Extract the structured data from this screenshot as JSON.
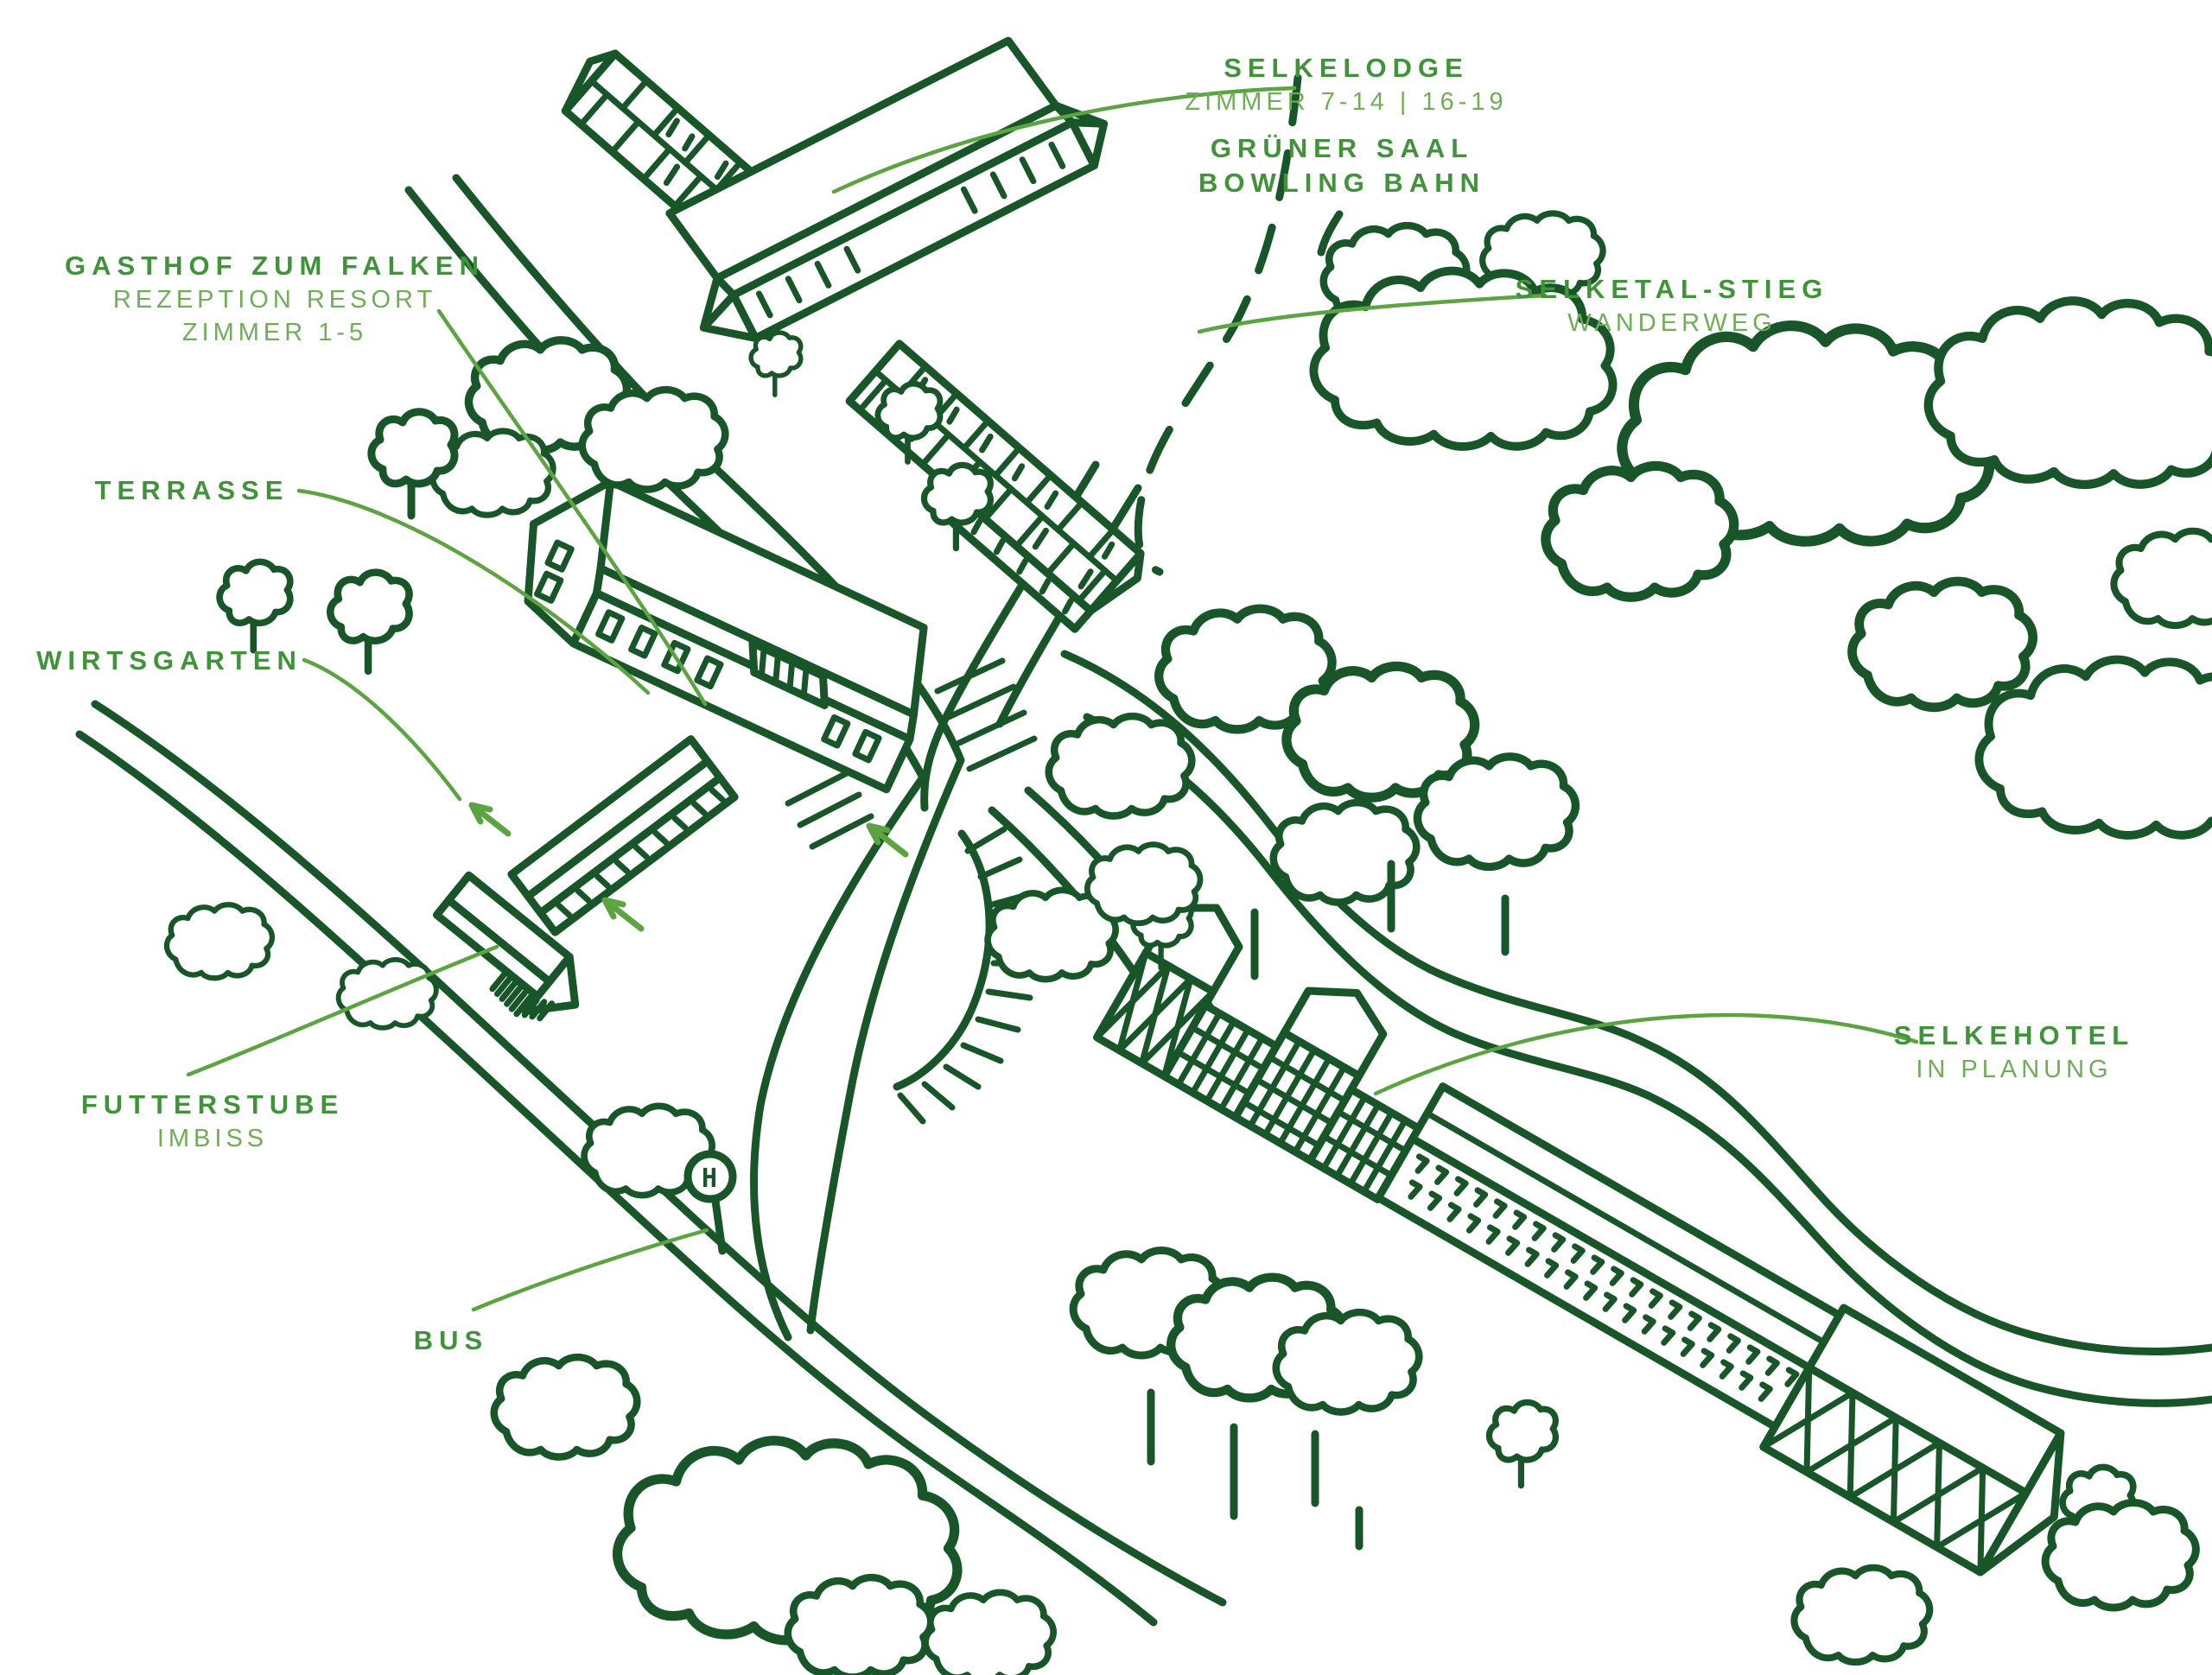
{
  "palette": {
    "ink": "#18562a",
    "label_strong": "#3f9338",
    "label_light": "#6fae56",
    "leader": "#5ba441",
    "background": "#ffffff"
  },
  "map_labels": {
    "selkelodge": {
      "title": "SELKELODGE",
      "subtitle": "ZIMMER 7-14 | 16-19"
    },
    "gruener_saal": {
      "line1": "GRÜNER SAAL",
      "line2": "BOWLING BAHN"
    },
    "gasthof": {
      "title": "GASTHOF ZUM FALKEN",
      "subtitle1": "REZEPTION RESORT",
      "subtitle2": "ZIMMER 1-5"
    },
    "selketal_stieg": {
      "title": "SELKETAL-STIEG",
      "subtitle": "WANDERWEG"
    },
    "terrasse": {
      "title": "TERRASSE"
    },
    "wirtsgarten": {
      "title": "WIRTSGARTEN"
    },
    "futterstube": {
      "title": "FUTTERSTUBE",
      "subtitle": "IMBISS"
    },
    "bus": {
      "title": "BUS"
    },
    "selkehotel": {
      "title": "SELKEHOTEL",
      "subtitle": "IN PLANUNG"
    }
  },
  "bus_stop": {
    "glyph": "H"
  }
}
